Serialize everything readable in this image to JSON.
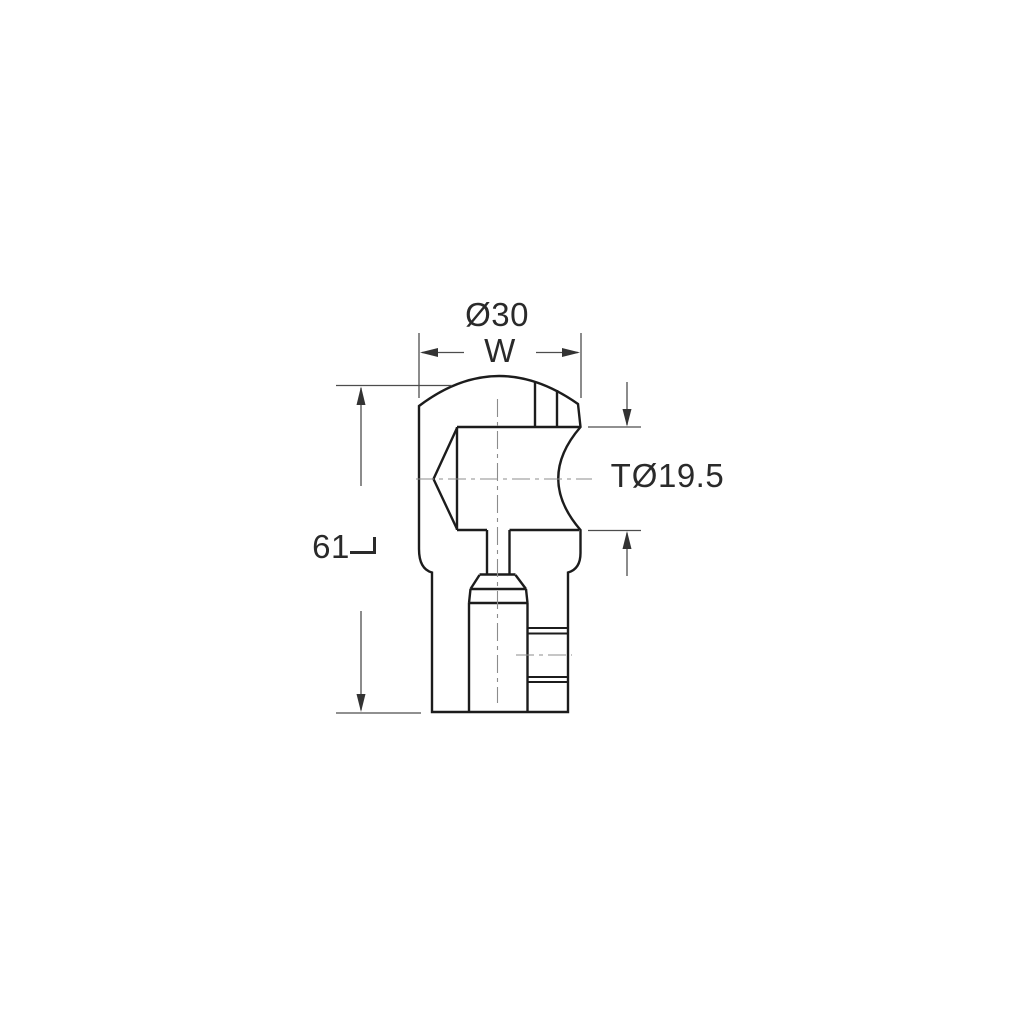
{
  "drawing": {
    "kind": "technical-dimension-drawing",
    "labels": {
      "top_diameter": "Ø30",
      "width_letter": "W",
      "thickness_letter": "T",
      "thickness_diameter": "Ø19.5",
      "length_value": "61",
      "length_symbol_icon": "corner-bracket"
    },
    "colors": {
      "background": "#ffffff",
      "outline": "#1c1c1c",
      "dimension_lines": "#4d4d4d",
      "centerlines": "#8c8c8c",
      "text": "#2a2a2a"
    }
  }
}
